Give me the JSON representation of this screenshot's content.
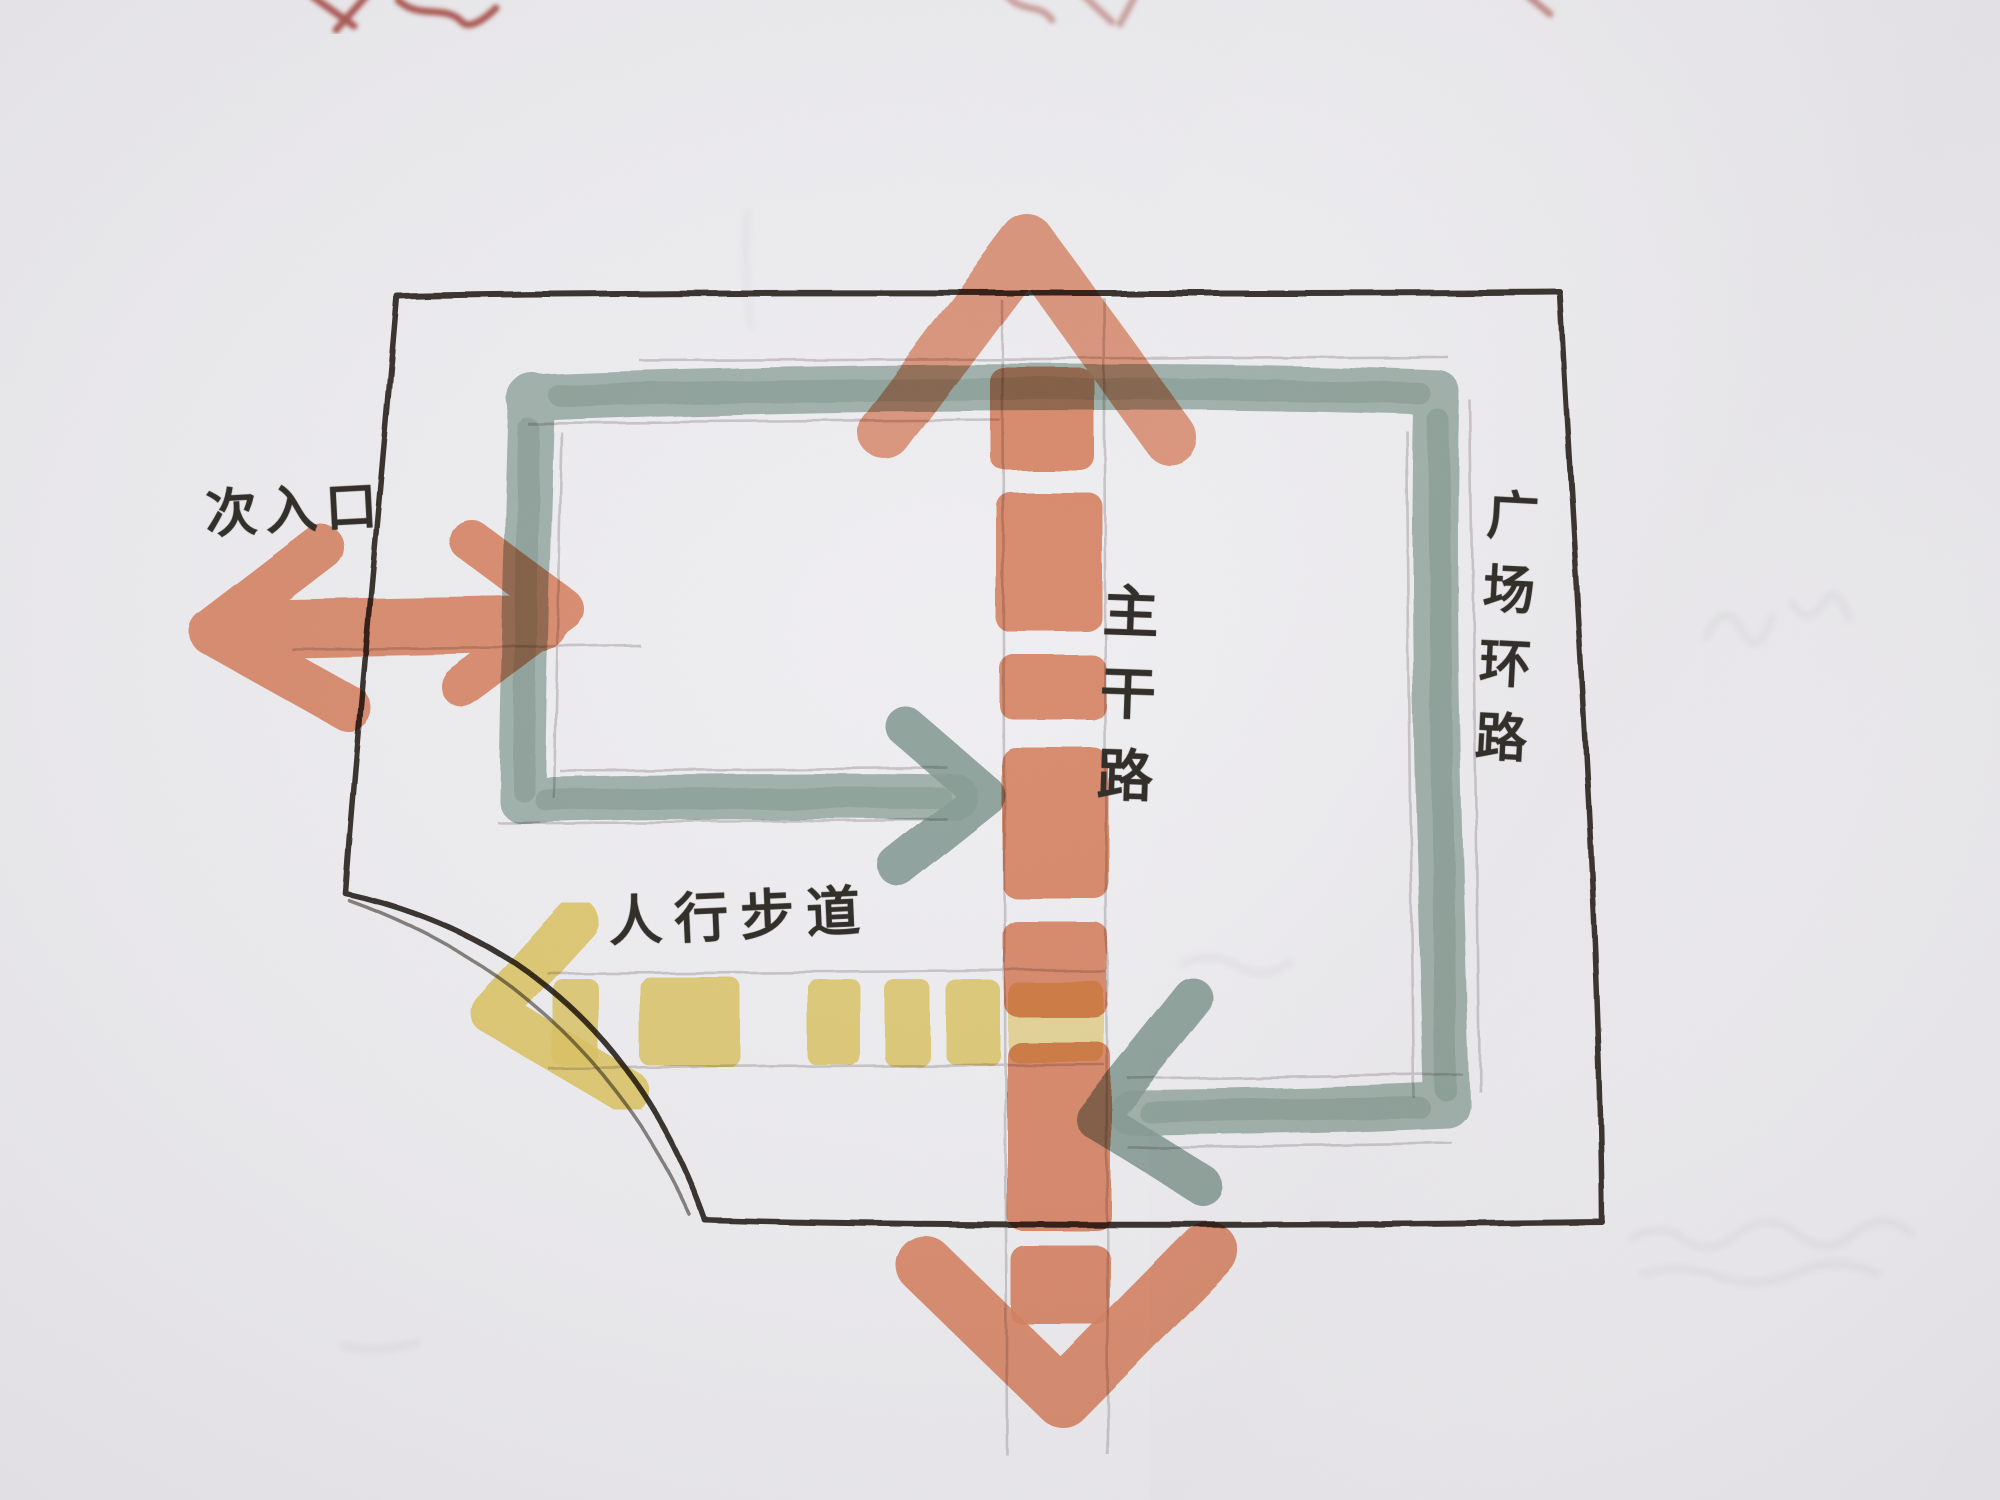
{
  "artwork": {
    "type": "hand-drawn site plan sketch, marker and pencil on photographed paper",
    "labels": {
      "secondary_entrance": "次入口",
      "main_road": "主干路",
      "pedestrian_walkway": "人行步道",
      "plaza_ring_road": "广场环路"
    },
    "features": [
      {
        "name": "site-boundary",
        "color_key": "ink",
        "style": "black outline rectangle with quarter-arc notch at lower left"
      },
      {
        "name": "main-road",
        "color_key": "road_orange",
        "style": "vertical dashed marker band with arrowheads pointing up and down"
      },
      {
        "name": "secondary-entrance-arrow",
        "color_key": "road_orange",
        "style": "horizontal double-headed arrow at left side"
      },
      {
        "name": "plaza-ring-road",
        "color_key": "ring_teal",
        "style": "rectangular loop, both lower branches end in arrowheads at the main road"
      },
      {
        "name": "pedestrian-walkway",
        "color_key": "path_yellow",
        "style": "dashed crosswalk band with left-pointing arrow"
      },
      {
        "name": "red-pen-marks",
        "color_key": "red_mark",
        "style": "partially cropped pen squiggles at the top paper edge"
      }
    ],
    "colors": {
      "paper": "#eae9ec",
      "ink": "#3a3632",
      "pencil": "#a8a1a4",
      "road_orange": "#e78f6c",
      "ring_teal": "#a0b5ab",
      "path_yellow": "#ecd46d",
      "red_mark": "#9c3a30",
      "text_ink": "#33302c"
    }
  }
}
